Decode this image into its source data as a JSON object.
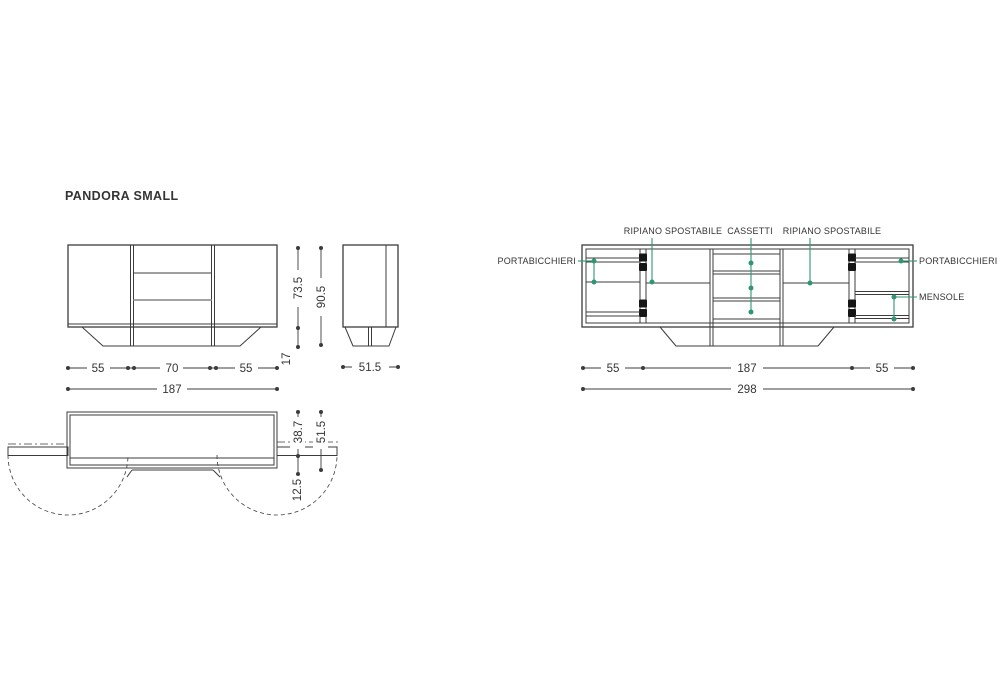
{
  "title": "PANDORA SMALL",
  "colors": {
    "line": "#3c3c3c",
    "light": "#a3a3a3",
    "accent": "#2e9577",
    "text": "#343434",
    "hinge": "#161616",
    "bg": "#ffffff"
  },
  "front_view": {
    "dim_left": "55",
    "dim_middle": "70",
    "dim_right": "55",
    "dim_width": "187",
    "dim_body_height": "73.5",
    "dim_total_height": "90.5",
    "dim_base_height": "17"
  },
  "side_view": {
    "dim_depth": "51.5"
  },
  "top_view": {
    "dim_body_depth": "38.7",
    "dim_total_depth": "51.5",
    "dim_door_clearance": "12.5"
  },
  "interior_view": {
    "label_ripiano_left": "RIPIANO SPOSTABILE",
    "label_cassetti": "CASSETTI",
    "label_ripiano_right": "RIPIANO SPOSTABILE",
    "label_portabicchieri_left": "PORTABICCHIERI",
    "label_portabicchieri_right": "PORTABICCHIERI",
    "label_mensole": "MENSOLE",
    "dim_left": "55",
    "dim_middle": "187",
    "dim_right": "55",
    "dim_total": "298"
  }
}
